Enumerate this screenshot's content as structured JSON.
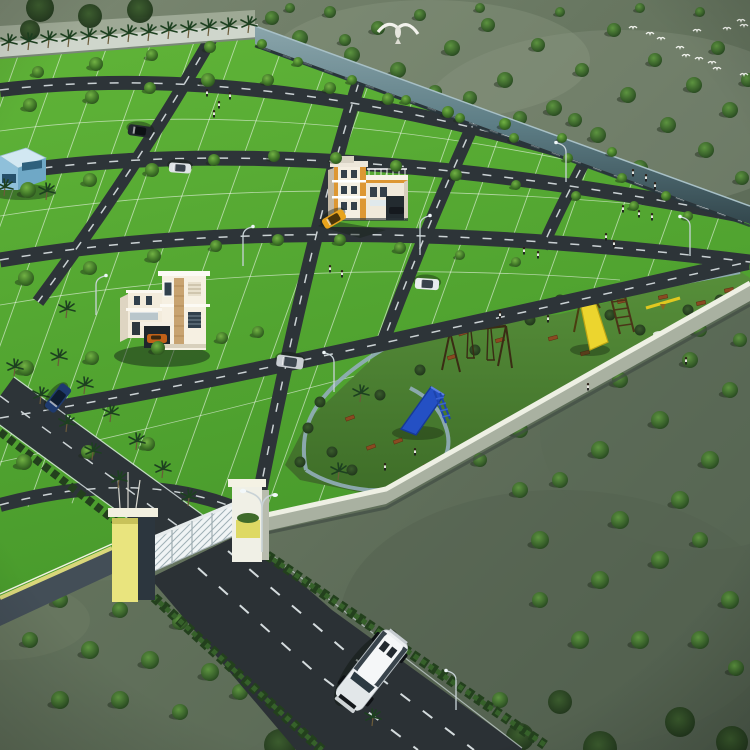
{
  "scene": {
    "title": "Aerial 3D render of plotted land development",
    "description": "Bird's-eye 3D visualization of a gated plotted layout: bright green plots divided by dark asphalt roads, palm-lined main avenue, children's park with slides and swings along the compound wall, two sample villas, entrance gate with white grill gates, exit road with a white SUV, surrounded by grey-green scrubland with scattered trees and flying birds.",
    "objects": [
      "plotted-estate",
      "boundary-walls",
      "entrance-gate",
      "main-avenue",
      "white-duplex-villa",
      "orange-apartment-building",
      "blue-site-office",
      "children-park",
      "blue-slide",
      "yellow-slide",
      "swing-set",
      "seesaw",
      "white-suv",
      "cars",
      "palm-trees",
      "street-lamps",
      "bird-flock",
      "eagle"
    ]
  },
  "colors": {
    "plot_green": "#53a72f",
    "plot_green_light": "#66bb3d",
    "park_green": "#4a7f31",
    "road": "#2d3438",
    "road_dash": "#e7eef0",
    "scrub_light": "#78856e",
    "scrub_dark": "#4c5a4a",
    "wall_ne": "#5d7d85",
    "wall_se_top": "#eef0e4",
    "wall_se_face": "#a9b1a1",
    "gate_yellow": "#e9e47e",
    "gate_slate": "#2f3941",
    "pillar_white": "#f0f0e6",
    "suv_body": "#eceff1",
    "slide_blue": "#2450c4",
    "slide_yellow": "#ecd52e",
    "bench_brown": "#8a4a22",
    "path_blue": "#8fb0bd",
    "hedge_dark": "#23401d",
    "hedge_light": "#36612a"
  },
  "layout": {
    "grid_b_xs": [
      20,
      64,
      108,
      152,
      196,
      240,
      284,
      328,
      372,
      416,
      460,
      504,
      548,
      592,
      636,
      680,
      724
    ],
    "estate_trees": [
      [
        38,
        72,
        6
      ],
      [
        96,
        64,
        7
      ],
      [
        152,
        55,
        6
      ],
      [
        210,
        47,
        6
      ],
      [
        262,
        44,
        5
      ],
      [
        30,
        105,
        7
      ],
      [
        92,
        97,
        7
      ],
      [
        150,
        88,
        6
      ],
      [
        208,
        80,
        7
      ],
      [
        268,
        80,
        6
      ],
      [
        330,
        88,
        6
      ],
      [
        388,
        99,
        6
      ],
      [
        448,
        112,
        6
      ],
      [
        505,
        124,
        6
      ],
      [
        562,
        138,
        5
      ],
      [
        612,
        152,
        5
      ],
      [
        28,
        190,
        8
      ],
      [
        90,
        180,
        7
      ],
      [
        152,
        170,
        7
      ],
      [
        214,
        160,
        6
      ],
      [
        274,
        156,
        6
      ],
      [
        336,
        158,
        6
      ],
      [
        396,
        166,
        6
      ],
      [
        456,
        175,
        6
      ],
      [
        516,
        185,
        5
      ],
      [
        576,
        196,
        5
      ],
      [
        634,
        206,
        5
      ],
      [
        688,
        216,
        5
      ],
      [
        26,
        278,
        8
      ],
      [
        90,
        268,
        7
      ],
      [
        154,
        256,
        7
      ],
      [
        216,
        246,
        6
      ],
      [
        278,
        240,
        6
      ],
      [
        340,
        240,
        6
      ],
      [
        400,
        248,
        6
      ],
      [
        460,
        255,
        5
      ],
      [
        516,
        262,
        5
      ],
      [
        26,
        368,
        8
      ],
      [
        92,
        358,
        7
      ],
      [
        158,
        348,
        7
      ],
      [
        222,
        338,
        6
      ],
      [
        258,
        332,
        6
      ],
      [
        24,
        462,
        8
      ],
      [
        88,
        452,
        7
      ],
      [
        148,
        444,
        7
      ],
      [
        298,
        62,
        5
      ],
      [
        352,
        80,
        5
      ],
      [
        406,
        100,
        5
      ],
      [
        460,
        118,
        5
      ],
      [
        514,
        138,
        5
      ],
      [
        568,
        158,
        5
      ],
      [
        622,
        178,
        5
      ],
      [
        666,
        196,
        5
      ]
    ],
    "scrub_trees": [
      [
        272,
        18,
        7
      ],
      [
        300,
        38,
        8
      ],
      [
        330,
        12,
        6
      ],
      [
        352,
        55,
        8
      ],
      [
        378,
        28,
        7
      ],
      [
        398,
        70,
        8
      ],
      [
        420,
        15,
        6
      ],
      [
        435,
        92,
        7
      ],
      [
        452,
        48,
        8
      ],
      [
        470,
        98,
        7
      ],
      [
        488,
        25,
        7
      ],
      [
        505,
        80,
        8
      ],
      [
        520,
        118,
        7
      ],
      [
        538,
        45,
        7
      ],
      [
        554,
        108,
        8
      ],
      [
        575,
        120,
        7
      ],
      [
        582,
        70,
        7
      ],
      [
        598,
        135,
        8
      ],
      [
        614,
        30,
        7
      ],
      [
        628,
        95,
        8
      ],
      [
        640,
        168,
        8
      ],
      [
        655,
        60,
        7
      ],
      [
        668,
        125,
        8
      ],
      [
        680,
        188,
        7
      ],
      [
        694,
        85,
        8
      ],
      [
        706,
        150,
        8
      ],
      [
        718,
        48,
        7
      ],
      [
        730,
        110,
        8
      ],
      [
        742,
        178,
        7
      ],
      [
        748,
        80,
        7
      ],
      [
        290,
        8,
        5
      ],
      [
        480,
        8,
        5
      ],
      [
        560,
        12,
        5
      ],
      [
        640,
        8,
        5
      ],
      [
        700,
        12,
        5
      ],
      [
        345,
        40,
        6
      ],
      [
        520,
        430,
        8
      ],
      [
        560,
        390,
        8
      ],
      [
        600,
        450,
        9
      ],
      [
        620,
        380,
        8
      ],
      [
        650,
        340,
        7
      ],
      [
        660,
        420,
        9
      ],
      [
        690,
        360,
        8
      ],
      [
        700,
        330,
        7
      ],
      [
        710,
        460,
        9
      ],
      [
        730,
        390,
        8
      ],
      [
        740,
        340,
        7
      ],
      [
        680,
        500,
        9
      ],
      [
        620,
        520,
        9
      ],
      [
        560,
        480,
        8
      ],
      [
        540,
        540,
        9
      ],
      [
        600,
        580,
        9
      ],
      [
        660,
        560,
        9
      ],
      [
        700,
        540,
        8
      ],
      [
        730,
        600,
        9
      ],
      [
        640,
        640,
        9
      ],
      [
        580,
        640,
        9
      ],
      [
        540,
        600,
        8
      ],
      [
        700,
        640,
        9
      ],
      [
        736,
        668,
        8
      ],
      [
        520,
        490,
        8
      ],
      [
        480,
        460,
        7
      ],
      [
        460,
        740,
        8
      ],
      [
        500,
        700,
        8
      ],
      [
        30,
        640,
        8
      ],
      [
        60,
        600,
        8
      ],
      [
        90,
        650,
        9
      ],
      [
        120,
        610,
        8
      ],
      [
        150,
        660,
        9
      ],
      [
        180,
        622,
        8
      ],
      [
        210,
        672,
        9
      ],
      [
        60,
        700,
        9
      ],
      [
        120,
        700,
        9
      ],
      [
        180,
        712,
        8
      ],
      [
        240,
        692,
        8
      ]
    ],
    "dark_canopies": [
      [
        280,
        745,
        16
      ],
      [
        350,
        752,
        18
      ],
      [
        520,
        737,
        14
      ],
      [
        600,
        748,
        17
      ],
      [
        680,
        722,
        15
      ],
      [
        732,
        742,
        16
      ],
      [
        560,
        702,
        12
      ],
      [
        40,
        8,
        14
      ],
      [
        90,
        16,
        12
      ],
      [
        140,
        10,
        13
      ],
      [
        30,
        30,
        10
      ]
    ],
    "palms_nw": [
      [
        8,
        51
      ],
      [
        28,
        50
      ],
      [
        48,
        48
      ],
      [
        68,
        47
      ],
      [
        88,
        45
      ],
      [
        108,
        44
      ],
      [
        128,
        42
      ],
      [
        148,
        41
      ],
      [
        168,
        39
      ],
      [
        188,
        38
      ],
      [
        208,
        36
      ],
      [
        228,
        35
      ],
      [
        248,
        33
      ]
    ],
    "palms_avenue": [
      [
        14,
        376
      ],
      [
        40,
        404
      ],
      [
        66,
        432
      ],
      [
        92,
        460
      ],
      [
        118,
        488
      ],
      [
        58,
        366
      ],
      [
        84,
        394
      ],
      [
        110,
        422
      ],
      [
        136,
        450
      ],
      [
        162,
        478
      ],
      [
        188,
        506
      ],
      [
        4,
        196
      ],
      [
        46,
        200
      ],
      [
        66,
        318
      ],
      [
        360,
        402
      ],
      [
        372,
        726
      ],
      [
        338,
        480
      ]
    ],
    "people": [
      [
        207,
        96
      ],
      [
        219,
        108
      ],
      [
        230,
        99
      ],
      [
        214,
        117
      ],
      [
        330,
        272
      ],
      [
        342,
        277
      ],
      [
        633,
        176
      ],
      [
        646,
        181
      ],
      [
        655,
        189
      ],
      [
        623,
        212
      ],
      [
        639,
        217
      ],
      [
        652,
        220
      ],
      [
        606,
        240
      ],
      [
        614,
        247
      ],
      [
        524,
        254
      ],
      [
        538,
        258
      ],
      [
        500,
        318
      ],
      [
        548,
        322
      ],
      [
        588,
        390
      ],
      [
        686,
        364
      ],
      [
        415,
        455
      ],
      [
        385,
        470
      ]
    ],
    "benches": [
      [
        463,
        333,
        -18
      ],
      [
        452,
        357,
        -18
      ],
      [
        500,
        340,
        -15
      ],
      [
        553,
        338,
        -15
      ],
      [
        585,
        353,
        -15
      ],
      [
        398,
        441,
        -20
      ],
      [
        428,
        465,
        -20
      ],
      [
        371,
        447,
        -20
      ],
      [
        350,
        418,
        -20
      ],
      [
        622,
        301,
        -12
      ],
      [
        663,
        297,
        -12
      ],
      [
        701,
        303,
        -12
      ],
      [
        729,
        290,
        -12
      ]
    ],
    "bushes": [
      [
        320,
        402
      ],
      [
        308,
        428
      ],
      [
        332,
        452
      ],
      [
        352,
        470
      ],
      [
        300,
        462
      ],
      [
        420,
        370
      ],
      [
        380,
        395
      ],
      [
        445,
        332
      ],
      [
        530,
        320
      ],
      [
        560,
        300
      ],
      [
        610,
        315
      ],
      [
        640,
        330
      ],
      [
        688,
        310
      ],
      [
        720,
        300
      ],
      [
        475,
        350
      ],
      [
        418,
        477
      ]
    ],
    "birds_flock": [
      [
        633,
        28
      ],
      [
        650,
        34
      ],
      [
        661,
        39
      ],
      [
        680,
        48
      ],
      [
        697,
        31
      ],
      [
        712,
        63
      ],
      [
        717,
        69
      ],
      [
        727,
        29
      ],
      [
        741,
        21
      ],
      [
        744,
        26
      ],
      [
        699,
        59
      ],
      [
        686,
        56
      ],
      [
        744,
        75
      ]
    ],
    "lamps": [
      [
        96,
        315,
        1
      ],
      [
        334,
        392,
        -1
      ],
      [
        690,
        256,
        -1
      ],
      [
        566,
        182,
        -1
      ],
      [
        243,
        266,
        1
      ],
      [
        456,
        710,
        -1
      ],
      [
        420,
        255,
        1
      ]
    ],
    "cars": [
      {
        "name": "car-dark-blue",
        "x": 58,
        "y": 398,
        "angle": 128,
        "len": 30,
        "wid": 13,
        "body": "#1e3a6e",
        "window": "#0e1c30"
      },
      {
        "name": "car-silver",
        "x": 290,
        "y": 362,
        "angle": 188,
        "len": 27,
        "wid": 12,
        "body": "#c9ced2",
        "window": "#3c464e"
      },
      {
        "name": "car-white",
        "x": 427,
        "y": 284,
        "angle": 184,
        "len": 24,
        "wid": 11,
        "body": "#e8ecee",
        "window": "#39434b"
      },
      {
        "name": "car-black",
        "x": 140,
        "y": 131,
        "angle": 188,
        "len": 24,
        "wid": 11,
        "body": "#23282e",
        "window": "#0d1114"
      },
      {
        "name": "car-white-2",
        "x": 180,
        "y": 168,
        "angle": 184,
        "len": 22,
        "wid": 10,
        "body": "#dfe4e6",
        "window": "#39434b"
      },
      {
        "name": "car-yellow-taxi",
        "x": 334,
        "y": 219,
        "angle": 150,
        "len": 24,
        "wid": 11,
        "body": "#e8a31c",
        "window": "#4a3508"
      }
    ]
  }
}
